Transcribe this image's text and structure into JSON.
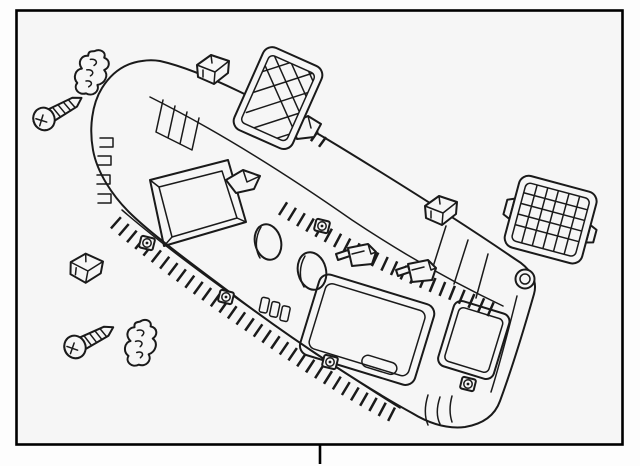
{
  "meta": {
    "subject": "liftgate interior trim panel parts diagram",
    "style": "black-and-white technical line art"
  },
  "colors": {
    "paper": "#fdfdfd",
    "canvas": "#f6f6f6",
    "line": "#1a1a1a",
    "border": "#000000"
  },
  "parts": [
    {
      "name": "trim-panel",
      "icon": "trim-panel-illustration"
    },
    {
      "name": "screw-top-left",
      "icon": "phillips-screw-icon"
    },
    {
      "name": "screw-bottom-left",
      "icon": "phillips-screw-icon"
    },
    {
      "name": "retainer-clip-top-left",
      "icon": "wavy-retainer-clip-icon"
    },
    {
      "name": "retainer-clip-bottom-left",
      "icon": "wavy-retainer-clip-icon"
    },
    {
      "name": "snap-clip-top-center",
      "icon": "box-clip-icon"
    },
    {
      "name": "snap-clip-middle-right",
      "icon": "box-clip-icon"
    },
    {
      "name": "snap-clip-left",
      "icon": "box-clip-icon"
    },
    {
      "name": "mesh-grille-top",
      "icon": "cross-hatch-grille-icon"
    },
    {
      "name": "mesh-grille-right",
      "icon": "cross-hatch-grille-icon"
    }
  ],
  "marks": {
    "fold_tick_position": "bottom-center"
  }
}
